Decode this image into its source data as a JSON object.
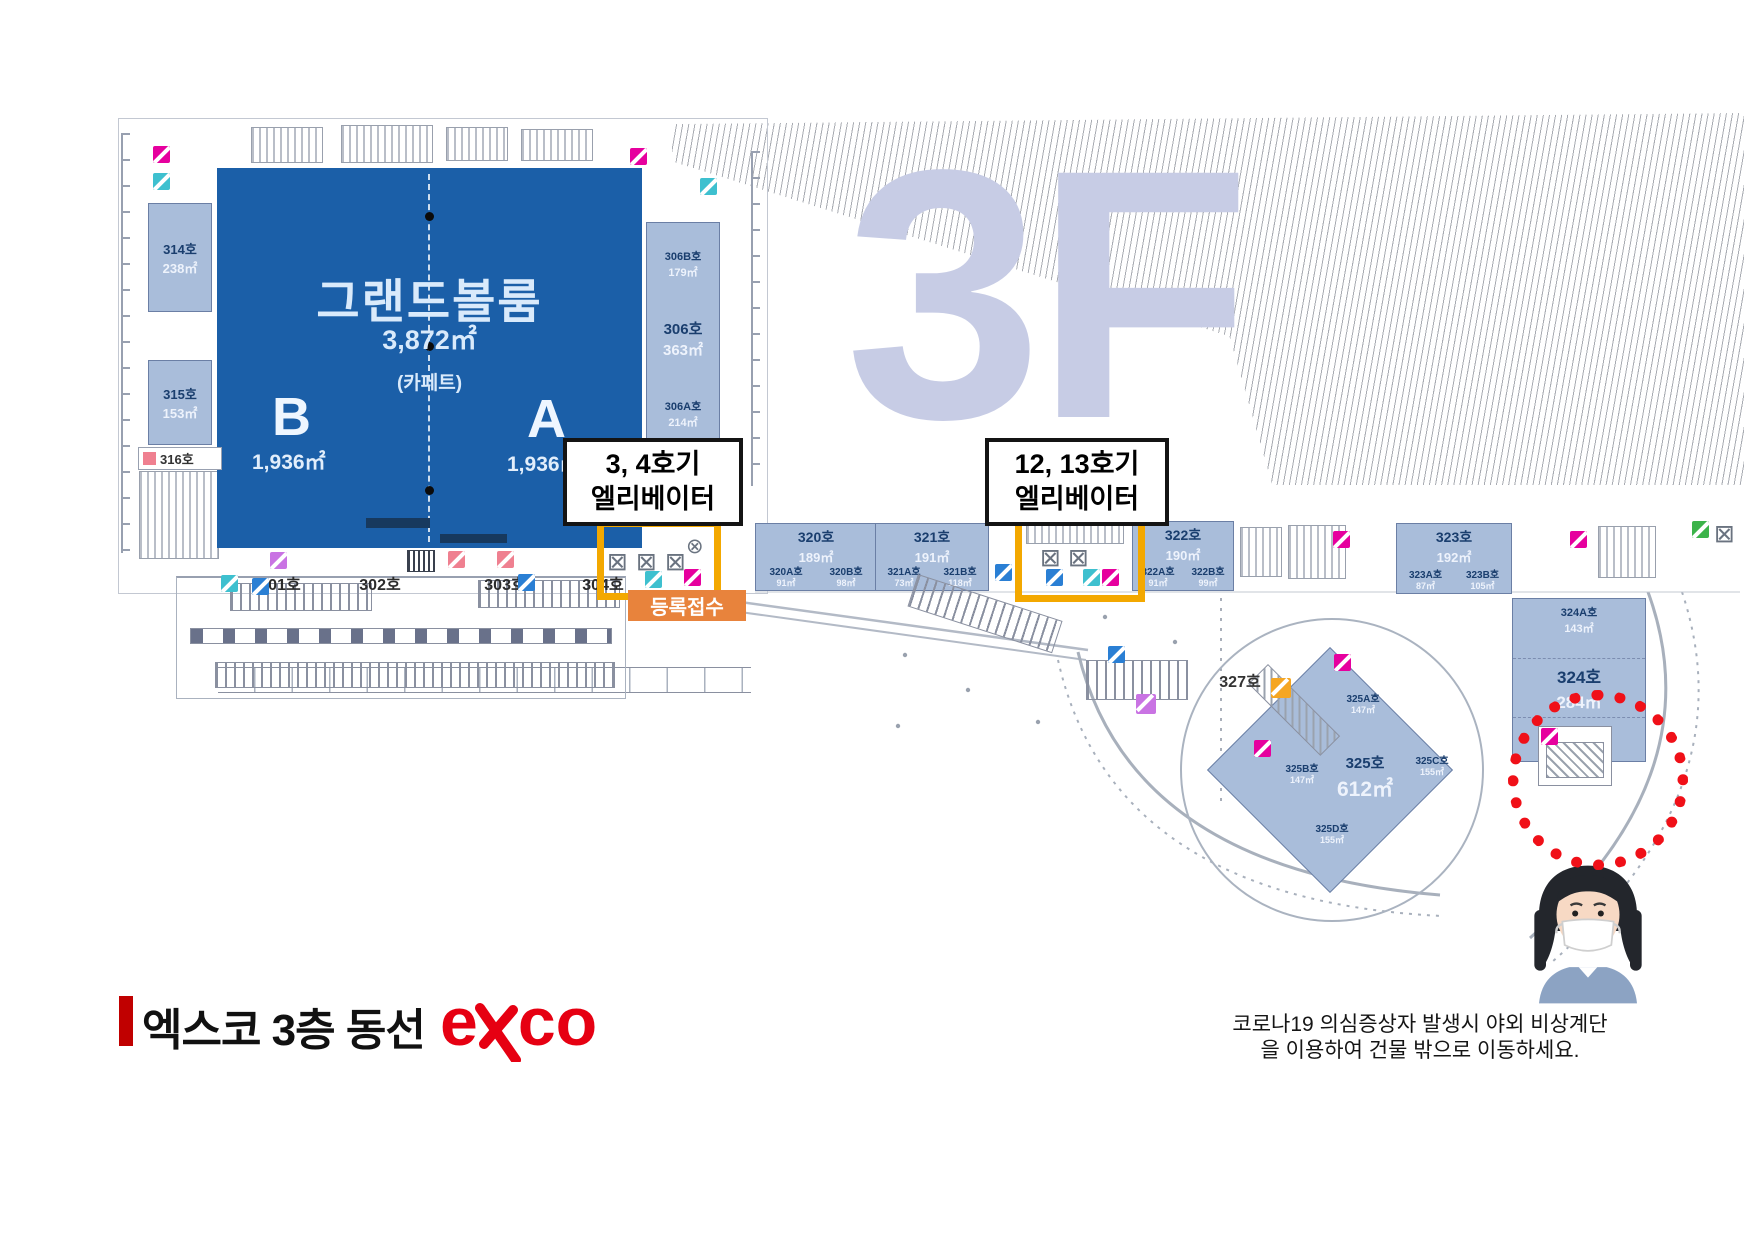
{
  "watermark": "3F",
  "header": {
    "title": "엑스코 3층 동선",
    "logo_e": "e",
    "logo_co": "co"
  },
  "notice": {
    "line1": "코로나19 의심증상자 발생시 야외 비상계단",
    "line2": "을 이용하여 건물 밖으로 이동하세요."
  },
  "registration": {
    "label": "등록접수"
  },
  "callouts": {
    "elevator_34": {
      "line1": "3, 4호기",
      "line2": "엘리베이터"
    },
    "elevator_1213": {
      "line1": "12, 13호기",
      "line2": "엘리베이터"
    }
  },
  "grand_ballroom": {
    "name": "그랜드볼룸",
    "area": "3,872㎡",
    "floor_note": "(카페트)",
    "hall_b": {
      "label": "B",
      "area": "1,936㎡"
    },
    "hall_a": {
      "label": "A",
      "area": "1,936㎡"
    }
  },
  "rooms": {
    "r314": {
      "label": "314호",
      "area": "238㎡"
    },
    "r315": {
      "label": "315호",
      "area": "153㎡"
    },
    "r316": {
      "label": "316호"
    },
    "r306b": {
      "label": "306B호",
      "area": "179㎡"
    },
    "r306": {
      "label": "306호",
      "area": "363㎡"
    },
    "r306a": {
      "label": "306A호",
      "area": "214㎡"
    },
    "bottom_row": [
      "301호",
      "302호",
      "303호",
      "304호"
    ],
    "strip": [
      {
        "label": "320호",
        "area": "189㎡",
        "subs": [
          {
            "label": "320A호",
            "area": "91㎡"
          },
          {
            "label": "320B호",
            "area": "98㎡"
          }
        ]
      },
      {
        "label": "321호",
        "area": "191㎡",
        "subs": [
          {
            "label": "321A호",
            "area": "73㎡"
          },
          {
            "label": "321B호",
            "area": "118㎡"
          }
        ]
      },
      {
        "label": "322호",
        "area": "190㎡",
        "subs": [
          {
            "label": "322A호",
            "area": "91㎡"
          },
          {
            "label": "322B호",
            "area": "99㎡"
          }
        ]
      },
      {
        "label": "323호",
        "area": "192㎡",
        "subs": [
          {
            "label": "323A호",
            "area": "87㎡"
          },
          {
            "label": "323B호",
            "area": "105㎡"
          }
        ]
      }
    ],
    "r327": {
      "label": "327호"
    },
    "r324": {
      "label": "324호",
      "area": "284㎡",
      "sub_top": {
        "label": "324A호",
        "area": "143㎡"
      },
      "sub_bottom": {
        "label": "324B호"
      }
    },
    "r325": {
      "label": "325호",
      "area": "612㎡",
      "sub_a": {
        "label": "325A호",
        "area": "147㎡"
      },
      "sub_b": {
        "label": "325B호",
        "area": "147㎡"
      },
      "sub_c": {
        "label": "325C호",
        "area": "155㎡"
      },
      "sub_d": {
        "label": "325D호",
        "area": "155㎡"
      }
    }
  },
  "colors": {
    "hall_blue": "#1b5fa8",
    "room_blue": "#a9bdda",
    "highlight_yellow": "#f3a800",
    "registration_orange": "#e8833c",
    "alert_red": "#f01018",
    "logo_red": "#e60012",
    "title_bar_red": "#c00000",
    "watermark_lavender": "#c7cce5",
    "icon_magenta": "#e6009e",
    "icon_cyan": "#3ec0cf",
    "icon_blue": "#2a7fd4",
    "icon_violet": "#c973e3",
    "icon_orange": "#f5a623",
    "icon_green": "#3cb34a",
    "icon_pink": "#ef8090"
  }
}
